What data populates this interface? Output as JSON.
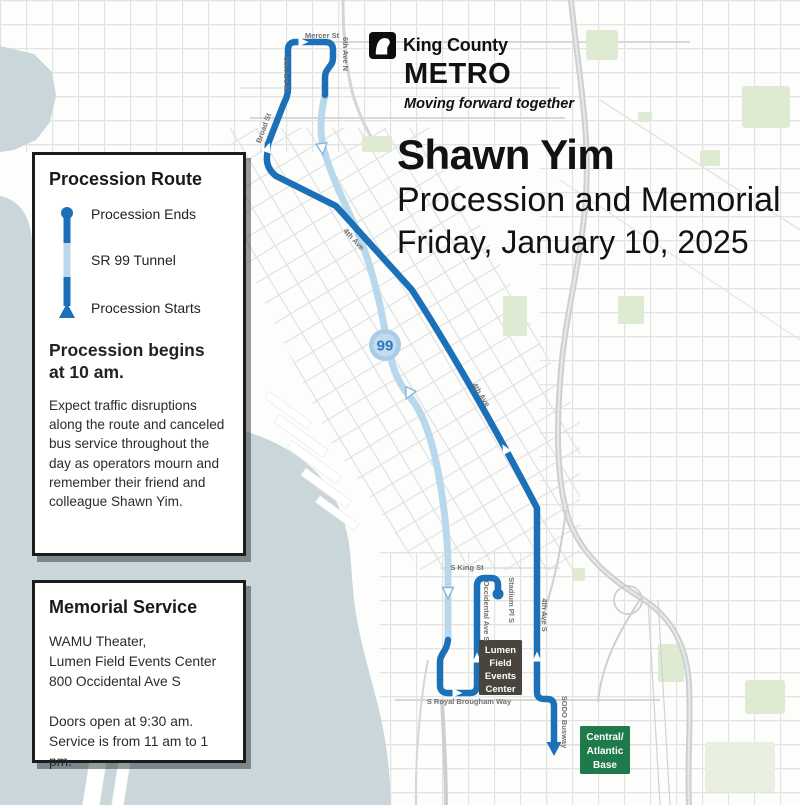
{
  "logo": {
    "org": "King County",
    "brand": "METRO",
    "tagline": "Moving forward together"
  },
  "title": {
    "line1": "Shawn Yim",
    "line2": "Procession and Memorial",
    "line3": "Friday, January 10, 2025"
  },
  "route_box": {
    "heading": "Procession Route",
    "legend": {
      "ends": "Procession Ends",
      "tunnel": "SR 99 Tunnel",
      "starts": "Procession Starts"
    },
    "begins_heading": "Procession begins at 10 am.",
    "body": "Expect traffic disruptions along the route and canceled bus service throughout the day as operators mourn and remember their friend and colleague Shawn Yim."
  },
  "memorial_box": {
    "heading": "Memorial Service",
    "address1": "WAMU Theater,",
    "address2": "Lumen Field Events Center",
    "address3": "800 Occidental Ave S",
    "time1": "Doors open at 9:30 am.",
    "time2": "Service is from 11 am to 1 pm."
  },
  "map": {
    "shield": "99",
    "streets": {
      "mercer": "Mercer St",
      "fifth_ave_n": "5th Ave N",
      "sixth_ave_n": "6th Ave N",
      "broad": "Broad St",
      "fourth_ave_1": "4th Ave",
      "fourth_ave_2": "4th Ave",
      "s_king": "S King St",
      "stadium_pl": "Stadium Pl S",
      "occidental": "Occidental Ave S",
      "fourth_ave_s": "4th Ave S",
      "royal_brougham": "S Royal Brougham Way",
      "sodo_busway": "SODO Busway"
    },
    "lumen": {
      "l1": "Lumen",
      "l2": "Field",
      "l3": "Events",
      "l4": "Center"
    },
    "base": {
      "l1": "Central/",
      "l2": "Atlantic",
      "l3": "Base"
    },
    "colors": {
      "route_blue": "#1b70b8",
      "tunnel_blue": "#b9d8ec",
      "water": "#c9d6da",
      "lumen_bg": "#49453e",
      "base_bg": "#1e7a4b"
    }
  }
}
